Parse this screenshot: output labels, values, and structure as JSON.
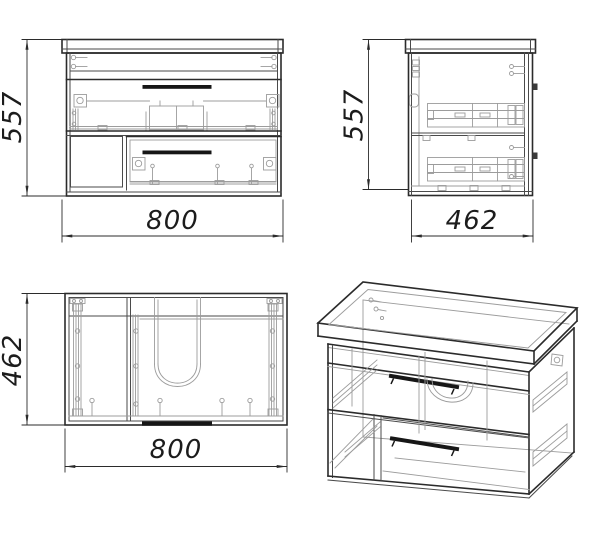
{
  "views": {
    "front": {
      "height_dim": "557",
      "width_dim": "800"
    },
    "side": {
      "height_dim": "557",
      "depth_dim": "462"
    },
    "top": {
      "depth_dim": "462",
      "width_dim": "800"
    }
  },
  "colors": {
    "background": "#ffffff",
    "main_line": "#2b2b2b",
    "hardware_line": "#9c9c9c",
    "handle": "#161616"
  }
}
